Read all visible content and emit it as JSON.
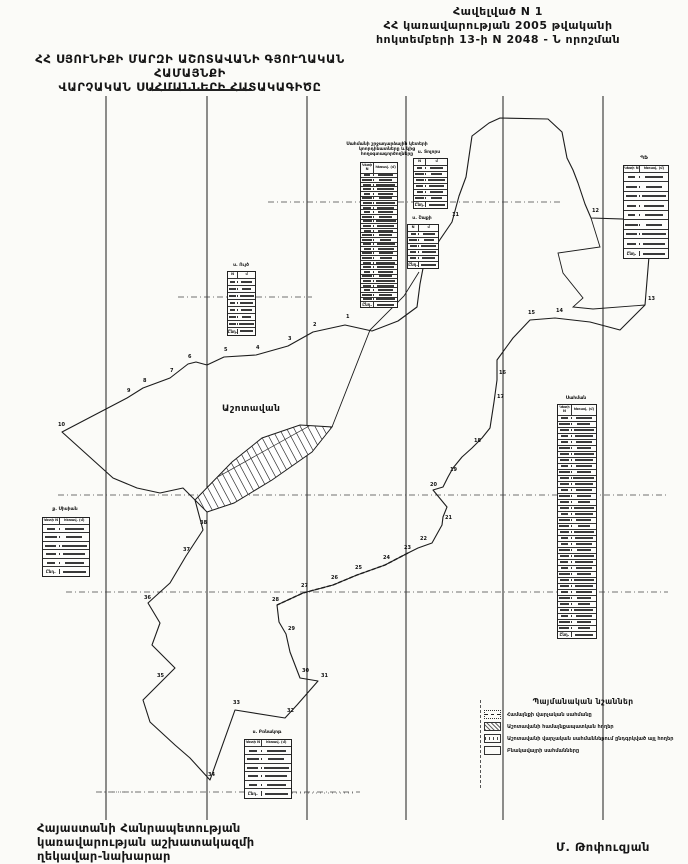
{
  "document": {
    "annex": {
      "lines": [
        "Հավելված  N   1",
        "ՀՀ կառավարության 2005 թվականի",
        "հոկտեմբերի 13-ի N 2048 - Ն որոշման"
      ]
    },
    "title": {
      "lines": [
        "ՀՀ ՍՅՈՒՆԻՔԻ ՄԱՐԶԻ ԱՇՈՏԱՎԱՆԻ ԳՅՈՒՂԱԿԱՆ ՀԱՄԱՅՆՔԻ",
        "ՎԱՐՉԱԿԱՆ   ՍԱՀՄԱՆՆԵՐԻ   ՀԱՏԱԿԱԳԻԾԸ"
      ]
    },
    "footer": {
      "left_lines": [
        "Հայաստանի Հանրապետության",
        "կառավարության աշխատակազմի",
        "ղեկավար-նախարար"
      ],
      "signature": "Մ. Թոփուզյան"
    }
  },
  "map": {
    "ink": "#1c1c1c",
    "village_label": "Աշոտավան",
    "grid": {
      "vertical_x": [
        106,
        207,
        307,
        406,
        503,
        603
      ],
      "v_top": 96,
      "v_bottom": 820,
      "horizontal": [
        {
          "y": 202,
          "x1": 268,
          "x2": 560
        },
        {
          "y": 297,
          "x1": 178,
          "x2": 312
        },
        {
          "y": 495,
          "x1": 58,
          "x2": 668
        },
        {
          "y": 592,
          "x1": 66,
          "x2": 668
        },
        {
          "y": 792,
          "x1": 96,
          "x2": 360
        }
      ]
    },
    "vectors": {
      "outer": "62,432 113,478 137,488 160,493 183,488 195,500 203,530 186,556 170,583 148,603 160,623 152,645 175,668 160,683 143,700 150,722 175,745 190,758 210,780 235,710 285,718 297,705 318,681 300,678 290,652 286,634 279,622 277,605 303,593 333,585 357,575 385,565 408,553 418,548 432,543 442,525 443,517 447,507 433,490 443,487 448,477 453,468 462,457 472,448 482,438 490,428 494,402 497,380 497,360 513,338 530,320 555,318 590,322 620,330 645,305 652,220 591,218 585,204 578,183 573,170 567,158 562,132 548,119 500,118 489,123 472,136 466,177 459,196 452,222 424,263 420,284 417,307 398,321 372,331 345,325 313,332 288,346 256,355 224,357 207,365 196,362 188,364 170,378 143,388 127,398",
      "inner1": "591,218 600,247 558,253 563,273 583,298 573,307 593,309 645,305",
      "inner2": "332,427 370,330 404,296 419,272",
      "se_dashed": "408,553 385,565 357,575 333,585 303,593 277,605",
      "village": "195,500 232,462 262,438 300,425 332,427 312,452 272,480 234,503 207,512"
    },
    "point_labels": [
      {
        "t": "1",
        "x": 346,
        "y": 318
      },
      {
        "t": "2",
        "x": 313,
        "y": 326
      },
      {
        "t": "3",
        "x": 288,
        "y": 340
      },
      {
        "t": "4",
        "x": 256,
        "y": 349
      },
      {
        "t": "5",
        "x": 224,
        "y": 351
      },
      {
        "t": "6",
        "x": 188,
        "y": 358
      },
      {
        "t": "7",
        "x": 170,
        "y": 372
      },
      {
        "t": "8",
        "x": 143,
        "y": 382
      },
      {
        "t": "9",
        "x": 127,
        "y": 392
      },
      {
        "t": "10",
        "x": 58,
        "y": 426
      },
      {
        "t": "11",
        "x": 452,
        "y": 216
      },
      {
        "t": "12",
        "x": 592,
        "y": 212
      },
      {
        "t": "13",
        "x": 648,
        "y": 300
      },
      {
        "t": "14",
        "x": 556,
        "y": 312
      },
      {
        "t": "15",
        "x": 528,
        "y": 314
      },
      {
        "t": "16",
        "x": 499,
        "y": 374
      },
      {
        "t": "17",
        "x": 497,
        "y": 398
      },
      {
        "t": "18",
        "x": 474,
        "y": 442
      },
      {
        "t": "19",
        "x": 450,
        "y": 471
      },
      {
        "t": "20",
        "x": 430,
        "y": 486
      },
      {
        "t": "21",
        "x": 445,
        "y": 519
      },
      {
        "t": "22",
        "x": 420,
        "y": 540
      },
      {
        "t": "23",
        "x": 404,
        "y": 549
      },
      {
        "t": "24",
        "x": 383,
        "y": 559
      },
      {
        "t": "25",
        "x": 355,
        "y": 569
      },
      {
        "t": "26",
        "x": 331,
        "y": 579
      },
      {
        "t": "27",
        "x": 301,
        "y": 587
      },
      {
        "t": "28",
        "x": 272,
        "y": 601
      },
      {
        "t": "29",
        "x": 288,
        "y": 630
      },
      {
        "t": "30",
        "x": 302,
        "y": 672
      },
      {
        "t": "31",
        "x": 321,
        "y": 677
      },
      {
        "t": "32",
        "x": 287,
        "y": 712
      },
      {
        "t": "33",
        "x": 233,
        "y": 704
      },
      {
        "t": "34",
        "x": 208,
        "y": 776
      },
      {
        "t": "35",
        "x": 157,
        "y": 677
      },
      {
        "t": "36",
        "x": 144,
        "y": 599
      },
      {
        "t": "37",
        "x": 183,
        "y": 551
      },
      {
        "t": "38",
        "x": 200,
        "y": 524
      }
    ],
    "tables": [
      {
        "id": "coords-main",
        "title_lines": [
          "Սահմանի շրջադարձային կետերի",
          "կոորդինատները և կից",
          "հողօգտագործողները"
        ],
        "title_x": 332,
        "title_y": 142,
        "title_w": 110,
        "x": 360,
        "y": 162,
        "w": 36,
        "rows": 28,
        "rh": 3.6,
        "headers": [
          "Կետի N",
          "հեռավ. (մ)"
        ],
        "footer": "Ընդ."
      },
      {
        "id": "coords-right",
        "title_lines": [
          "Սահման"
        ],
        "title_x": 552,
        "title_y": 396,
        "title_w": 48,
        "x": 557,
        "y": 404,
        "w": 38,
        "rows": 36,
        "rh": 5,
        "headers": [
          "Կետի N",
          "հեռավ. (մ)"
        ],
        "footer": "Ընդ."
      },
      {
        "id": "adj-tolors",
        "title_lines": [
          "ս. Տոլորս"
        ],
        "title_x": 405,
        "title_y": 150,
        "title_w": 48,
        "x": 413,
        "y": 158,
        "w": 33,
        "rows": 6,
        "rh": 5,
        "headers": [
          "N",
          "մ"
        ],
        "footer": "Ընդ."
      },
      {
        "id": "adj-shaki",
        "title_lines": [
          "ս. Շաքի"
        ],
        "title_x": 400,
        "title_y": 216,
        "title_w": 44,
        "x": 407,
        "y": 224,
        "w": 30,
        "rows": 5,
        "rh": 5,
        "headers": [
          "N",
          "մ"
        ],
        "footer": "Ընդ."
      },
      {
        "id": "adj-uyts",
        "title_lines": [
          "ս. Ույծ"
        ],
        "title_x": 219,
        "title_y": 263,
        "title_w": 44,
        "x": 227,
        "y": 271,
        "w": 27,
        "rows": 7,
        "rh": 6,
        "headers": [
          "N",
          "մ"
        ],
        "footer": "Ընդ."
      },
      {
        "id": "adj-sisian",
        "title_lines": [
          "ք. Սիսիան"
        ],
        "title_x": 36,
        "title_y": 507,
        "title_w": 58,
        "x": 42,
        "y": 517,
        "w": 46,
        "rows": 5,
        "rh": 7.5,
        "headers": [
          "Կետի N",
          "հեռավ. (մ)"
        ],
        "footer": "Ընդ."
      },
      {
        "id": "adj-brnakot",
        "title_lines": [
          "ս. Բռնակոթ"
        ],
        "title_x": 236,
        "title_y": 730,
        "title_w": 62,
        "x": 244,
        "y": 739,
        "w": 46,
        "rows": 5,
        "rh": 7.5,
        "headers": [
          "Կետի N",
          "հեռավ. (մ)"
        ],
        "footer": "Ընդ."
      },
      {
        "id": "adj-pf",
        "title_lines": [
          "ՊՖ"
        ],
        "title_x": 618,
        "title_y": 156,
        "title_w": 52,
        "x": 623,
        "y": 165,
        "w": 44,
        "rows": 8,
        "rh": 8.5,
        "headers": [
          "Կետի N",
          "հեռավ. (մ)"
        ],
        "footer": "Ընդ."
      }
    ],
    "legend": {
      "title": "Պայմանական նշաններ",
      "items": [
        {
          "symbol": "boundary-line",
          "label": "Համայնքի վարչական սահմանը"
        },
        {
          "symbol": "hatch-box",
          "label": "Աշոտավանի համայնքապատկան հողեր"
        },
        {
          "symbol": "tick-box",
          "label": "Աշոտավանի վարչական սահմաններում ընդգրկված այլ հողեր"
        },
        {
          "symbol": "empty-box",
          "label": "Բնակավայրի սահմանները"
        }
      ]
    }
  }
}
